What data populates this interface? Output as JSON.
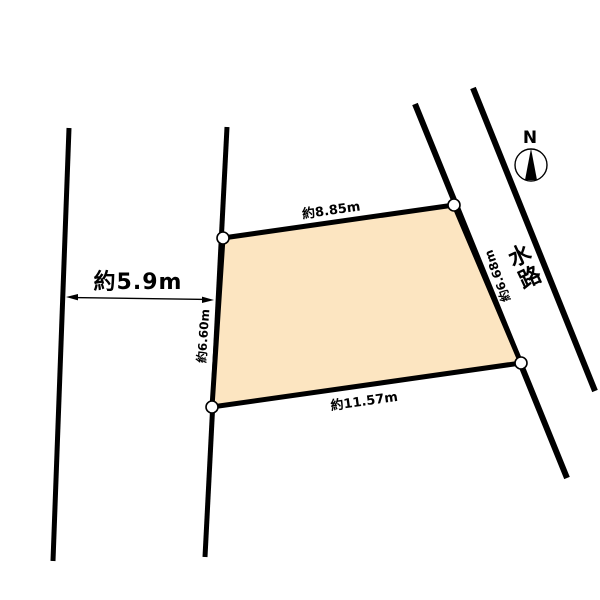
{
  "plan": {
    "compass": {
      "north_label": "N"
    },
    "waterway": {
      "name": "水路"
    },
    "road": {
      "width_label": "約5.9m"
    },
    "parcel": {
      "fill_color": "#FCE5C1",
      "edge_labels": {
        "north": "約8.85m",
        "east": "約6.68m",
        "south": "約11.57m",
        "west": "約6.60m"
      }
    },
    "line_color": "#000000"
  }
}
